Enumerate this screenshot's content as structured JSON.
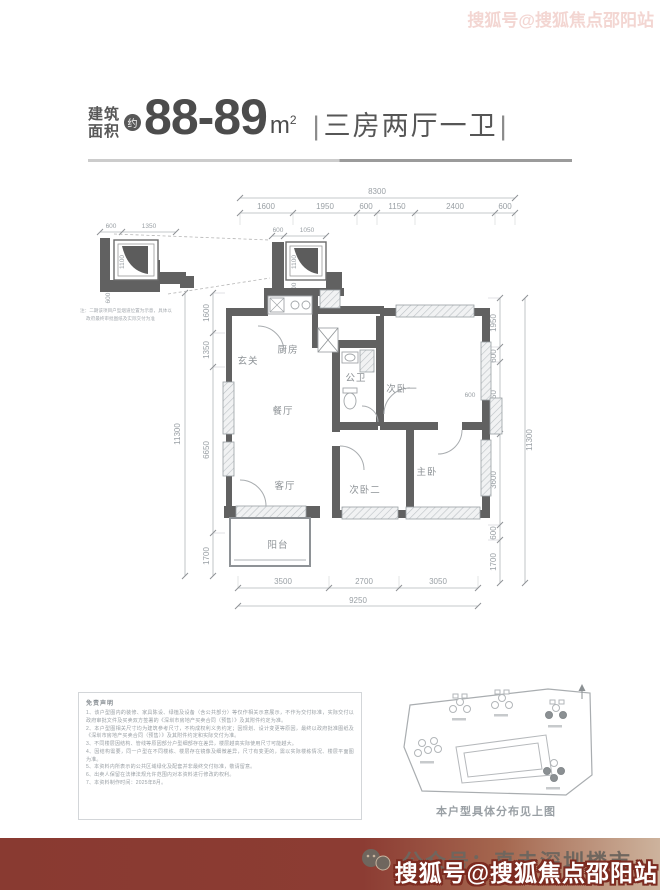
{
  "header": {
    "area_prefix_1": "建筑",
    "area_prefix_2": "面积",
    "approx_badge": "约",
    "area_value": "88-89",
    "area_unit": "m",
    "area_unit_sup": "2",
    "layout_sep": "|",
    "layout_text": "三房两厅一卫"
  },
  "plan": {
    "rooms": {
      "entry": "玄关",
      "kitchen": "厨房",
      "bath": "公卫",
      "bed1": "次卧一",
      "dining": "餐厅",
      "living": "客厅",
      "bed2": "次卧二",
      "master": "主卧",
      "balcony": "阳台"
    },
    "dims": {
      "top_total": "8300",
      "top": [
        "1600",
        "1950",
        "600",
        "1150",
        "2400",
        "600"
      ],
      "left_total": "11300",
      "left": [
        "1600",
        "1350",
        "6650",
        "1700"
      ],
      "right_total": "11300",
      "right": [
        "1950",
        "600",
        "2850",
        "3600",
        "600",
        "1700"
      ],
      "bottom_total": "9250",
      "bottom": [
        "3500",
        "2700",
        "3050"
      ],
      "inner": [
        "600",
        "450"
      ],
      "flue_top": [
        "600",
        "1050"
      ],
      "flue_side": [
        "1100",
        "600"
      ],
      "detail_top": [
        "600",
        "1350"
      ],
      "detail_side": [
        "1100",
        "600"
      ]
    },
    "detail_notes": [
      "注：二期该项目户型烟道位置为示意，具体以",
      "政府最终审批图纸及实际交付为准"
    ]
  },
  "disclaimer": {
    "title": "免责声明",
    "items": [
      "1、该户型图内的装修、家具陈设、绿植及设备（含公共部分）等仅作相关示意展示，不作为交付标准，实际交付以政府审批文件及买卖双方签署的《深圳市房地产买卖合同（预售）》及其附件约定为准。",
      "2、本户型图相关尺寸均为建筑参考尺寸，不构成权利义务约定；因规划、设计变更等原因，最终以政府批准图纸及《深圳市房地产买卖合同（预售）》及其附件约定和实际交付为准。",
      "3、不同楼层因结构、管线等原因部分户型细部存在差异，楼层越高实际使用尺寸可能越大。",
      "4、因结构需要，同一户型在不同楼栋、楼层存在镜像及细微差异，尺寸有变更的，需以实际楼栋情况、楼层平面图为准。",
      "5、本资料内所表示的公共区域绿化及配套并非最终交付标准，敬请留意。",
      "6、出卖人保留在法律法规允许范围内对本资料进行修改的权利。",
      "7、本资料制作时间：2025年8月。"
    ]
  },
  "site": {
    "caption": "本户型具体分布见上图"
  },
  "footer": {
    "account": "公众号：直击深圳楼市",
    "watermark": "搜狐号@搜狐焦点邵阳站",
    "watermark_top": "搜狐号@搜狐焦点邵阳站"
  },
  "colors": {
    "maroon": "#8a3a31",
    "wall": "#616161",
    "dim_text": "#9aa0a5",
    "title_text": "#4c4c4c"
  }
}
